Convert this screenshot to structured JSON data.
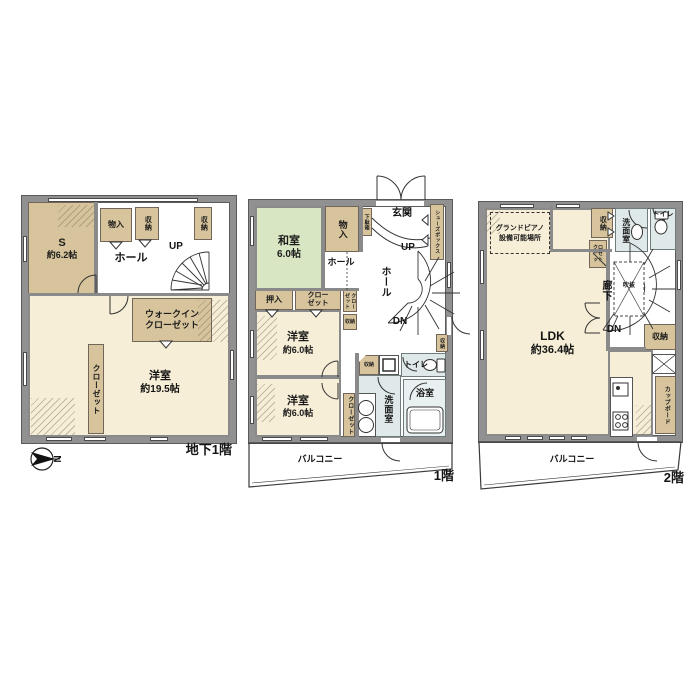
{
  "colors": {
    "wall": "#919191",
    "room_cream": "#f6eed6",
    "closet_tan": "#d7c49c",
    "tatami_green": "#d9e6c3",
    "wet_blue": "#dfe9ea",
    "bath_blue": "#e9f0f1"
  },
  "b1": {
    "floor_label": "地下1階",
    "compass_n": "N",
    "up": "UP",
    "s_name": "S",
    "s_size": "約6.2帖",
    "monoire": "物入",
    "shuno_a": "収納",
    "shuno_b": "収納",
    "hall": "ホール",
    "wic1": "ウォークイン",
    "wic2": "クローゼット",
    "closet": "クローゼット",
    "yoshitsu_name": "洋室",
    "yoshitsu_size": "約19.5帖"
  },
  "f1": {
    "floor_label": "1階",
    "up": "UP",
    "dn": "DN",
    "washitsu_name": "和室",
    "washitsu_size": "6.0帖",
    "monoire": "物入",
    "getabako": "下駄箱",
    "genkan": "玄関",
    "shoes_box": "シューズボックス",
    "hall_a": "ホール",
    "hall_b": "ホール",
    "oshiire": "押入",
    "closet_a": "クローゼット",
    "closet_b": "クローゼット",
    "closet_c": "クローゼット",
    "shuno_a": "収納",
    "shuno_b": "収納",
    "shuno_c": "収納",
    "yoshitsu1_name": "洋室",
    "yoshitsu1_size": "約6.0帖",
    "yoshitsu2_name": "洋室",
    "yoshitsu2_size": "約6.0帖",
    "senmen": "洗面室",
    "toilet": "トイレ",
    "bath": "浴室",
    "balcony": "バルコニー"
  },
  "f2": {
    "floor_label": "2階",
    "dn": "DN",
    "piano1": "グランドピアノ",
    "piano2": "設備可能場所",
    "shuno_top": "収納",
    "closet": "クローゼット",
    "senmen": "洗面室",
    "toilet": "トイレ",
    "rouka": "廊下",
    "fukinuke": "吹抜",
    "shuno_right": "収納",
    "cupboard": "カップボード",
    "ldk_name": "LDK",
    "ldk_size": "約36.4帖",
    "balcony": "バルコニー"
  }
}
